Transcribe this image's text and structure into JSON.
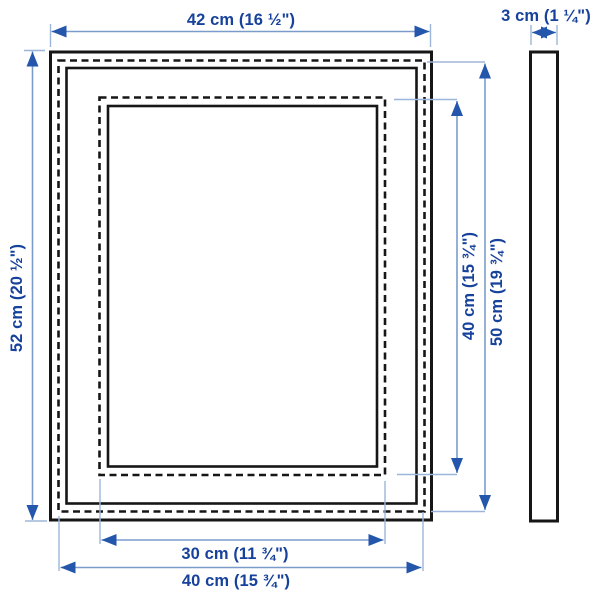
{
  "labels": {
    "front_width": "42 cm (16 ½\")",
    "front_height": "52 cm (20 ½\")",
    "picture_height": "40 cm (15 ¾\")",
    "back_height": "50 cm (19 ¾\")",
    "picture_width": "30 cm (11 ¾\")",
    "back_width": "40 cm (15 ¾\")",
    "depth": "3 cm (1 ¼\")"
  },
  "colors": {
    "label_text": "#17429b",
    "dimension_line": "#7b9ccb",
    "extension_line": "#9db5d9",
    "arrowhead": "#2456ab",
    "frame_outline": "#161616",
    "background": "#ffffff"
  }
}
